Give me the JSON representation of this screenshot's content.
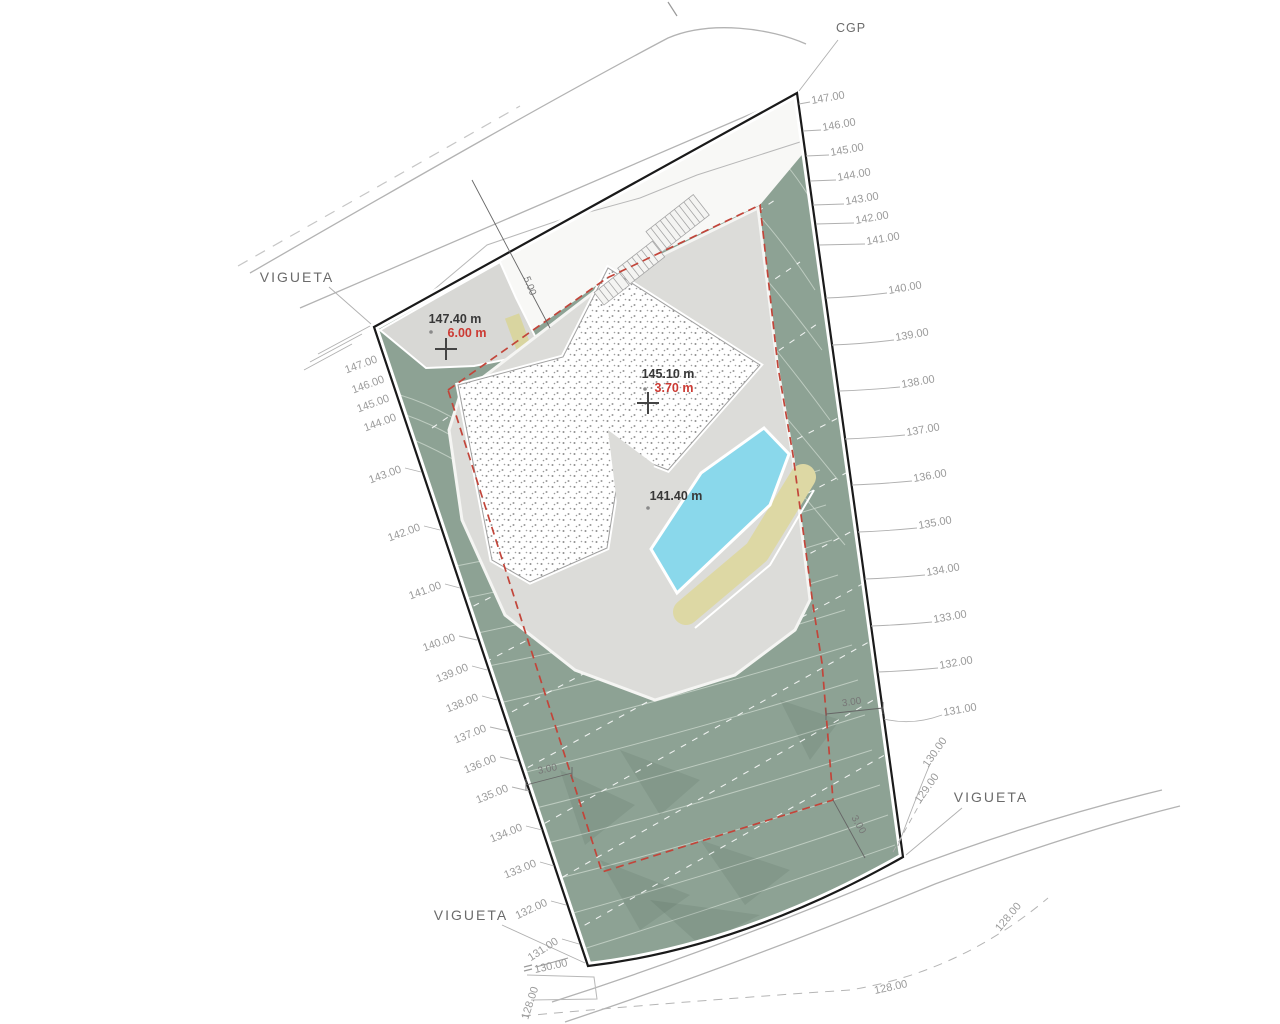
{
  "plan": {
    "cgp_label": "CGP",
    "vigueta_label": "VIGUETA",
    "spot_elevations": {
      "entry": {
        "elevation": "147.40 m",
        "setback": "6.00 m"
      },
      "house": {
        "elevation": "145.10 m",
        "setback": "3.70 m"
      },
      "pool": {
        "elevation": "141.40 m"
      }
    },
    "setback_dims": {
      "front": "5.00",
      "left": "3.00",
      "right": "3.00",
      "rear": "3.00"
    },
    "contours": {
      "left": [
        "147.00",
        "146.00",
        "145.00",
        "144.00",
        "143.00",
        "142.00",
        "141.00",
        "140.00",
        "139.00",
        "138.00",
        "137.00",
        "136.00",
        "135.00",
        "134.00",
        "133.00",
        "132.00",
        "131.00",
        "130.00"
      ],
      "right": [
        "147.00",
        "146.00",
        "145.00",
        "144.00",
        "143.00",
        "142.00",
        "141.00",
        "140.00",
        "139.00",
        "138.00",
        "137.00",
        "136.00",
        "135.00",
        "134.00",
        "133.00",
        "132.00",
        "131.00",
        "130.00",
        "129.00"
      ],
      "road": [
        "128.00",
        "128.00",
        "128.00"
      ]
    },
    "colors": {
      "terrain": "#8da294",
      "pool": "#8ad8eb",
      "sand": "#ddd8a4",
      "setback_line": "#c2453a",
      "terrace": "#dcdcd9"
    }
  }
}
